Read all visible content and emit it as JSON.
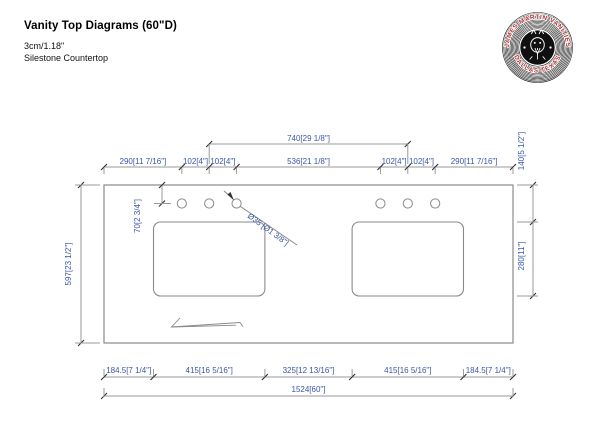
{
  "header": {
    "title": "Vanity Top Diagrams (60\"D)",
    "thickness": "3cm/1.18\"",
    "material": "Silestone Countertop"
  },
  "logo": {
    "top_text": "JAMES MARTIN VANITIES",
    "bottom_text": "DALLAS TEXAS",
    "text_color": "#b23230"
  },
  "colors": {
    "dim_text": "#3b57a8",
    "line": "#9a9a9a",
    "outline": "#8a8a8a",
    "tick": "#2f2f2f"
  },
  "diagram": {
    "top_span": "740[29 1/8\"]",
    "top_chain": [
      "290[11 7/16\"]",
      "102[4\"]",
      "102[4\"]",
      "536[21 1/8\"]",
      "102[4\"]",
      "102[4\"]",
      "290[11 7/16\"]"
    ],
    "left_height": "597[23 1/2\"]",
    "hole_offset": "70[2 3/4\"]",
    "edge_to_sink": "140[5 1/2\"]",
    "sink_depth": "280[11\"]",
    "bottom_chain": [
      "184.5[7 1/4\"]",
      "415[16 5/16\"]",
      "325[12 13/16\"]",
      "415[16 5/16\"]",
      "184.5[7 1/4\"]"
    ],
    "total_width": "1524[60\"]",
    "hole_diameter": "Ø35 [Ø1 3/8\"]"
  }
}
